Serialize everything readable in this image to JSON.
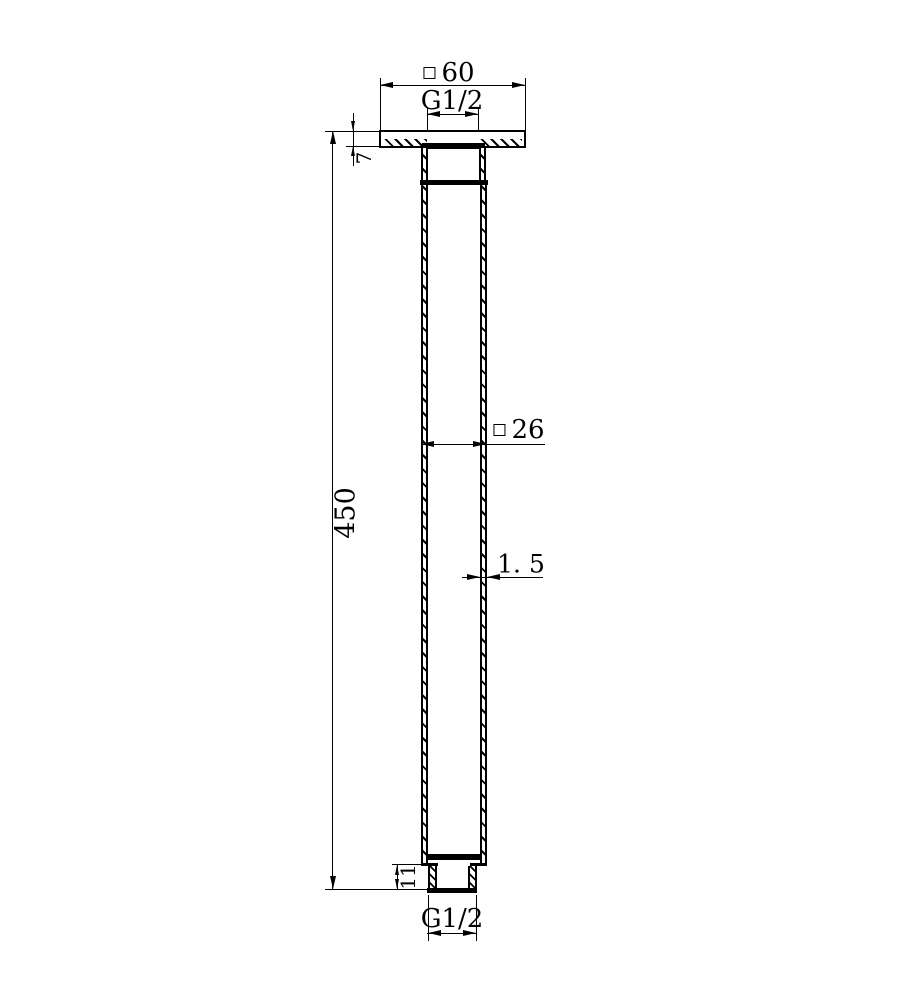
{
  "drawing": {
    "type": "technical-dimension-drawing",
    "colors": {
      "line": "#000000",
      "background": "#ffffff"
    },
    "dimensions": {
      "top_width": {
        "symbol": "square",
        "value": "60"
      },
      "top_thread": {
        "value": "G1/2"
      },
      "flange_thickness": {
        "value": "7"
      },
      "length": {
        "value": "450"
      },
      "tube_width": {
        "symbol": "square",
        "value": "26"
      },
      "wall_thickness": {
        "value": "1. 5"
      },
      "fitting_height": {
        "value": "11"
      },
      "bottom_thread": {
        "value": "G1/2"
      }
    }
  }
}
